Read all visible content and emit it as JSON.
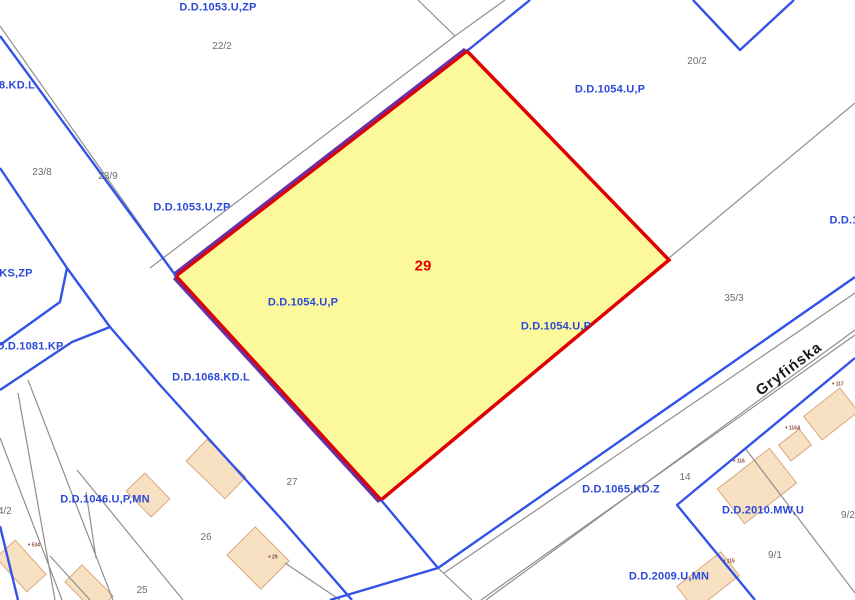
{
  "map": {
    "type": "cadastral-zoning-plan",
    "street": {
      "name": "Gryfińska"
    },
    "selected_parcel": {
      "number": "29"
    },
    "colors": {
      "zoning_blue": "#3353E8",
      "label_blue": "#2B48D8",
      "cadastral_gray": "#8F8F8F",
      "parcel_fill": "#FBF99B",
      "parcel_stroke": "#E10000",
      "overlay_purple": "#6C2FA3",
      "building_fill": "#F8E0C2",
      "building_stroke": "#D9A87D",
      "number_gray": "#6E6E6E",
      "address_maroon": "#8B4A3B",
      "street_black": "#1A1A1A",
      "background": "#FFFFFF"
    },
    "labels": [
      {
        "type": "zone",
        "text": "D.D.1053.U,ZP",
        "x": 218,
        "y": 8
      },
      {
        "type": "zone",
        "text": "D.D.1053.U,ZP",
        "x": 192,
        "y": 208
      },
      {
        "type": "zone",
        "text": "D.D.1054.U,P",
        "x": 610,
        "y": 90
      },
      {
        "type": "zone",
        "text": "D.D.1054.U,P",
        "x": 303,
        "y": 303
      },
      {
        "type": "zone",
        "text": "D.D.1054.U,P",
        "x": 556,
        "y": 327
      },
      {
        "type": "zone",
        "text": "D.D.1068.KD.L",
        "x": 211,
        "y": 378
      },
      {
        "type": "zone",
        "text": "D.D.1081.KP",
        "x": 30,
        "y": 347
      },
      {
        "type": "zone",
        "text": "KS,ZP",
        "x": 16,
        "y": 274
      },
      {
        "type": "zone",
        "text": "8.KD.L",
        "x": 17,
        "y": 86
      },
      {
        "type": "zone",
        "text": "D.D.1046.U,P,MN",
        "x": 105,
        "y": 500
      },
      {
        "type": "zone",
        "text": "D.D.1065.KD.Z",
        "x": 621,
        "y": 490
      },
      {
        "type": "zone",
        "text": "D.D.2010.MW,U",
        "x": 763,
        "y": 511
      },
      {
        "type": "zone",
        "text": "D.D.2009.U,MN",
        "x": 669,
        "y": 577
      },
      {
        "type": "zone",
        "text": "D.D.1",
        "x": 844,
        "y": 221
      },
      {
        "type": "num",
        "text": "22/2",
        "x": 222,
        "y": 47
      },
      {
        "type": "num",
        "text": "20/2",
        "x": 697,
        "y": 62
      },
      {
        "type": "num",
        "text": "23/8",
        "x": 42,
        "y": 173
      },
      {
        "type": "num",
        "text": "23/9",
        "x": 108,
        "y": 177
      },
      {
        "type": "num",
        "text": "35/3",
        "x": 734,
        "y": 299
      },
      {
        "type": "num",
        "text": "27",
        "x": 292,
        "y": 483
      },
      {
        "type": "num",
        "text": "26",
        "x": 206,
        "y": 538
      },
      {
        "type": "num",
        "text": "25",
        "x": 142,
        "y": 591
      },
      {
        "type": "num",
        "text": "24/2",
        "x": 2,
        "y": 512
      },
      {
        "type": "num",
        "text": "14",
        "x": 685,
        "y": 478
      },
      {
        "type": "num",
        "text": "9/1",
        "x": 775,
        "y": 556
      },
      {
        "type": "num",
        "text": "9/2",
        "x": 848,
        "y": 516
      },
      {
        "type": "sel",
        "text": "29",
        "x": 423,
        "y": 266
      },
      {
        "type": "street",
        "text": "Gryfińska",
        "x": 789,
        "y": 369,
        "rot": -37
      },
      {
        "type": "addr",
        "text": "534",
        "x": 34,
        "y": 546
      },
      {
        "type": "addr",
        "text": "29",
        "x": 273,
        "y": 558
      },
      {
        "type": "addr",
        "text": "117",
        "x": 838,
        "y": 385
      },
      {
        "type": "addr",
        "text": "116A",
        "x": 793,
        "y": 429
      },
      {
        "type": "addr",
        "text": "116",
        "x": 739,
        "y": 462
      },
      {
        "type": "addr",
        "text": "115",
        "x": 729,
        "y": 562
      }
    ]
  }
}
